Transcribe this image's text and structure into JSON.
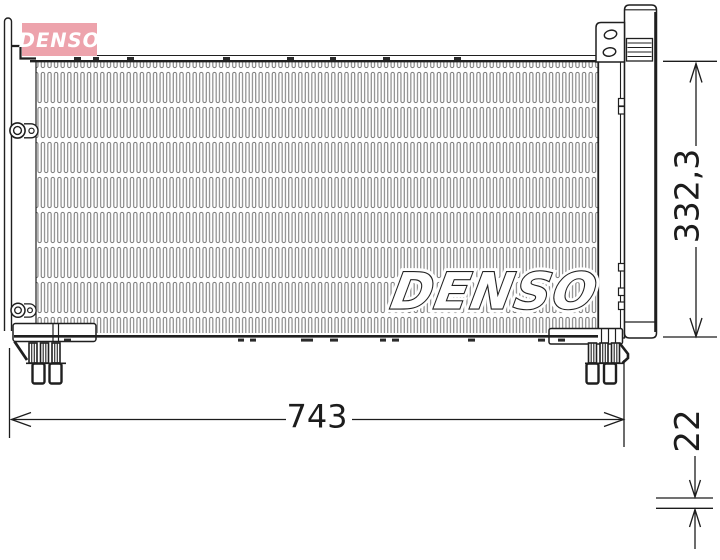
{
  "logo": {
    "text": "DENSO",
    "bg_color": "#eda3ac",
    "fg_color": "#ffffff"
  },
  "watermark": {
    "text": "DENSO"
  },
  "dimensions": {
    "width_label": "743",
    "height_label": "332,3",
    "depth_label": "22"
  },
  "drawing": {
    "line_color": "#1f1f1f",
    "fin_color": "#7b7b7b"
  }
}
